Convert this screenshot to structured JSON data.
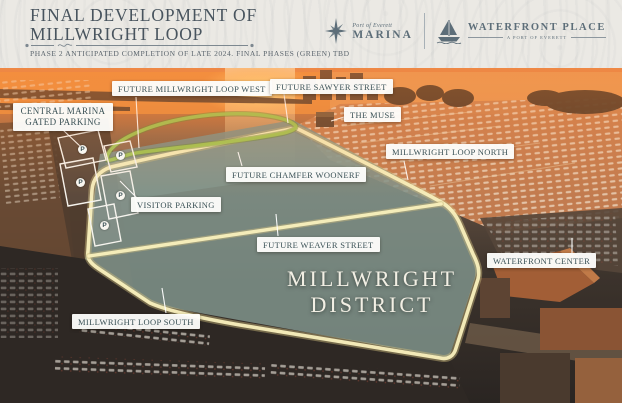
{
  "header": {
    "title_line1": "FINAL DEVELOPMENT OF",
    "title_line2": "MILLWRIGHT LOOP",
    "subtitle": "PHASE 2 ANTICIPATED COMPLETION OF LATE 2024. FINAL PHASES (GREEN) TBD",
    "logos": {
      "marina_pre": "Port of Everett",
      "marina_name": "MARINA",
      "waterfront_name": "WATERFRONT PLACE",
      "waterfront_tagline": "A PORT OF EVERETT"
    }
  },
  "map": {
    "district_line1": "MILLWRIGHT",
    "district_line2": "DISTRICT",
    "parking_marker": "P",
    "colors": {
      "phase2_road": "#f9f0bd",
      "final_phase_road": "#a2c653",
      "label_text": "#3a5156"
    },
    "labels": [
      {
        "id": "central-marina-gated-parking",
        "text": "CENTRAL MARINA GATED PARKING"
      },
      {
        "id": "future-millwright-loop-west",
        "text": "FUTURE MILLWRIGHT LOOP WEST"
      },
      {
        "id": "future-sawyer-street",
        "text": "FUTURE SAWYER STREET"
      },
      {
        "id": "the-muse",
        "text": "THE MUSE"
      },
      {
        "id": "millwright-loop-north",
        "text": "MILLWRIGHT LOOP NORTH"
      },
      {
        "id": "future-chamfer-woonerf",
        "text": "FUTURE CHAMFER WOONERF"
      },
      {
        "id": "visitor-parking",
        "text": "VISITOR PARKING"
      },
      {
        "id": "future-weaver-street",
        "text": "FUTURE WEAVER STREET"
      },
      {
        "id": "waterfront-center",
        "text": "WATERFRONT CENTER"
      },
      {
        "id": "millwright-loop-south",
        "text": "MILLWRIGHT LOOP SOUTH"
      }
    ]
  }
}
